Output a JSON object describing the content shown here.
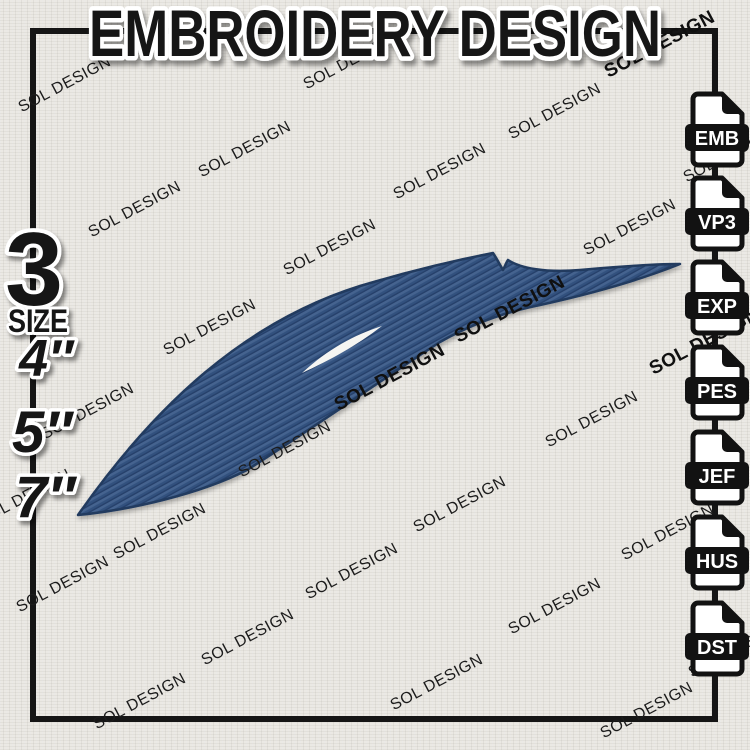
{
  "title": "EMBROIDERY DESIGN",
  "watermark_text": "SOL DESIGN",
  "size_panel": {
    "count": "3",
    "label": "SIZE",
    "options": [
      "4″",
      "5″",
      "7″"
    ]
  },
  "format_icons": [
    "EMB",
    "VP3",
    "EXP",
    "PES",
    "JEF",
    "HUS",
    "DST"
  ],
  "design": {
    "description": "Navy blue embroidered swoosh with notched fin and white stitch highlight",
    "thread_color": "#32517e"
  },
  "colors": {
    "fabric": "#ebe9e4",
    "ink": "#141414",
    "sticker_white": "#ffffff",
    "thread_navy": "#32517e",
    "thread_light": "#45648f",
    "thread_dark": "#27416b",
    "shape_outline": "#203a5f",
    "highlight": "#f5f5f2"
  }
}
